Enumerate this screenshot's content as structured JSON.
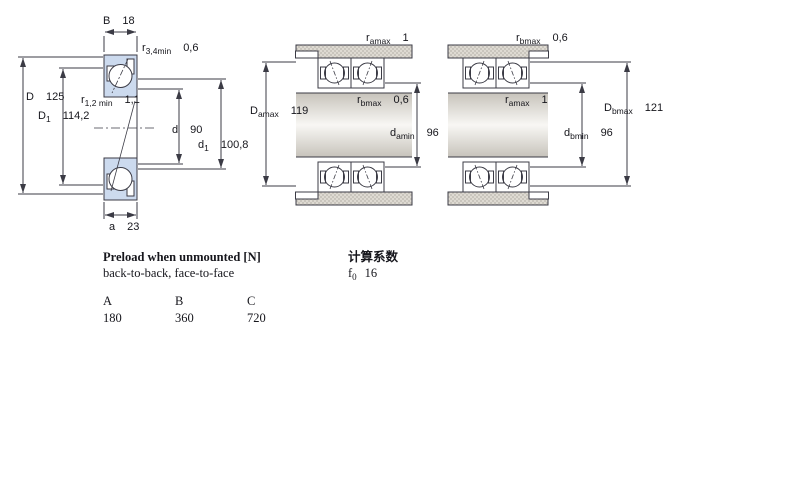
{
  "drawing": {
    "colors": {
      "line": "#3b3b45",
      "bearing_fill": "#ccdaee",
      "housing_fill": "#d4d0c8"
    },
    "left_view": {
      "dims": {
        "B": {
          "base": "B",
          "sub": "",
          "value": "18"
        },
        "r34": {
          "base": "r",
          "sub": "3,4min",
          "value": "0,6"
        },
        "D": {
          "base": "D",
          "sub": "",
          "value": "125"
        },
        "D1": {
          "base": "D",
          "sub": "1",
          "value": "114,2"
        },
        "r12": {
          "base": "r",
          "sub": "1,2 min",
          "value": "1,1"
        },
        "d": {
          "base": "d",
          "sub": "",
          "value": "90"
        },
        "d1": {
          "base": "d",
          "sub": "1",
          "value": "100,8"
        },
        "a": {
          "base": "a",
          "sub": "",
          "value": "23"
        }
      }
    },
    "middle_view": {
      "dims": {
        "r_amax": {
          "base": "r",
          "sub": "amax",
          "value": "1"
        },
        "D_amax": {
          "base": "D",
          "sub": "amax",
          "value": "119"
        },
        "r_bmax": {
          "base": "r",
          "sub": "bmax",
          "value": "0,6"
        },
        "d_amin": {
          "base": "d",
          "sub": "amin",
          "value": "96"
        }
      }
    },
    "right_view": {
      "dims": {
        "r_bmax": {
          "base": "r",
          "sub": "bmax",
          "value": "0,6"
        },
        "r_amax": {
          "base": "r",
          "sub": "amax",
          "value": "1"
        },
        "D_bmax": {
          "base": "D",
          "sub": "bmax",
          "value": "121"
        },
        "d_bmin": {
          "base": "d",
          "sub": "bmin",
          "value": "96"
        }
      }
    }
  },
  "info": {
    "preload_title": "Preload when unmounted [N]",
    "preload_subtitle": "back-to-back, face-to-face",
    "preload_table": {
      "headers": [
        "A",
        "B",
        "C"
      ],
      "values": [
        "180",
        "360",
        "720"
      ]
    },
    "calc_title": "计算系数",
    "f0": {
      "base": "f",
      "sub": "0",
      "value": "16"
    }
  }
}
